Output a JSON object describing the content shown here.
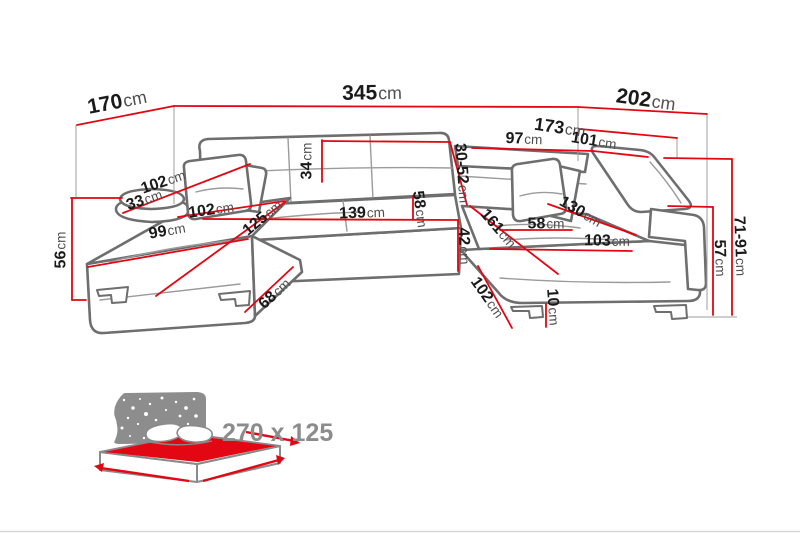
{
  "colors": {
    "dimension_line": "#e30613",
    "sofa_outline": "#6e6e6e",
    "label_number": "#1a1a1a",
    "label_unit": "#4f4f4f",
    "footprint_text": "#8c8c8c",
    "bed_icon_accent": "#e30613",
    "bed_icon_blanket": "#8d8d8d"
  },
  "dimensions": [
    {
      "id": "left-depth-total",
      "value": "170",
      "unit": "cm"
    },
    {
      "id": "back-width-total",
      "value": "345",
      "unit": "cm"
    },
    {
      "id": "right-depth-total",
      "value": "202",
      "unit": "cm"
    },
    {
      "id": "right-depth-inner",
      "value": "173",
      "unit": "cm"
    },
    {
      "id": "back-segment",
      "value": "97",
      "unit": "cm"
    },
    {
      "id": "right-back-segment",
      "value": "101",
      "unit": "cm"
    },
    {
      "id": "left-arm-width",
      "value": "102",
      "unit": "cm"
    },
    {
      "id": "left-bolster-height",
      "value": "33",
      "unit": "cm"
    },
    {
      "id": "backrest-cushion-height",
      "value": "34",
      "unit": "cm"
    },
    {
      "id": "headrest-height-range",
      "value": "30-52",
      "unit": "cm"
    },
    {
      "id": "left-seat-width",
      "value": "102",
      "unit": "cm"
    },
    {
      "id": "left-front-width",
      "value": "99",
      "unit": "cm"
    },
    {
      "id": "left-chaise-depth",
      "value": "125",
      "unit": "cm"
    },
    {
      "id": "middle-seat-width",
      "value": "139",
      "unit": "cm"
    },
    {
      "id": "seat-depth",
      "value": "58",
      "unit": "cm"
    },
    {
      "id": "middle-front-height",
      "value": "42",
      "unit": "cm"
    },
    {
      "id": "right-chaise-length",
      "value": "161",
      "unit": "cm"
    },
    {
      "id": "right-seat-segment",
      "value": "58",
      "unit": "cm"
    },
    {
      "id": "right-backrest-width",
      "value": "130",
      "unit": "cm"
    },
    {
      "id": "right-seat-width",
      "value": "103",
      "unit": "cm"
    },
    {
      "id": "left-height",
      "value": "56",
      "unit": "cm"
    },
    {
      "id": "left-chaise-side-depth",
      "value": "68",
      "unit": "cm"
    },
    {
      "id": "right-chaise-side-depth",
      "value": "102",
      "unit": "cm"
    },
    {
      "id": "leg-height",
      "value": "10",
      "unit": "cm"
    },
    {
      "id": "arm-height",
      "value": "57",
      "unit": "cm"
    },
    {
      "id": "back-height-range",
      "value": "71-91",
      "unit": "cm"
    }
  ],
  "footprint": {
    "value": "270 x 125"
  }
}
